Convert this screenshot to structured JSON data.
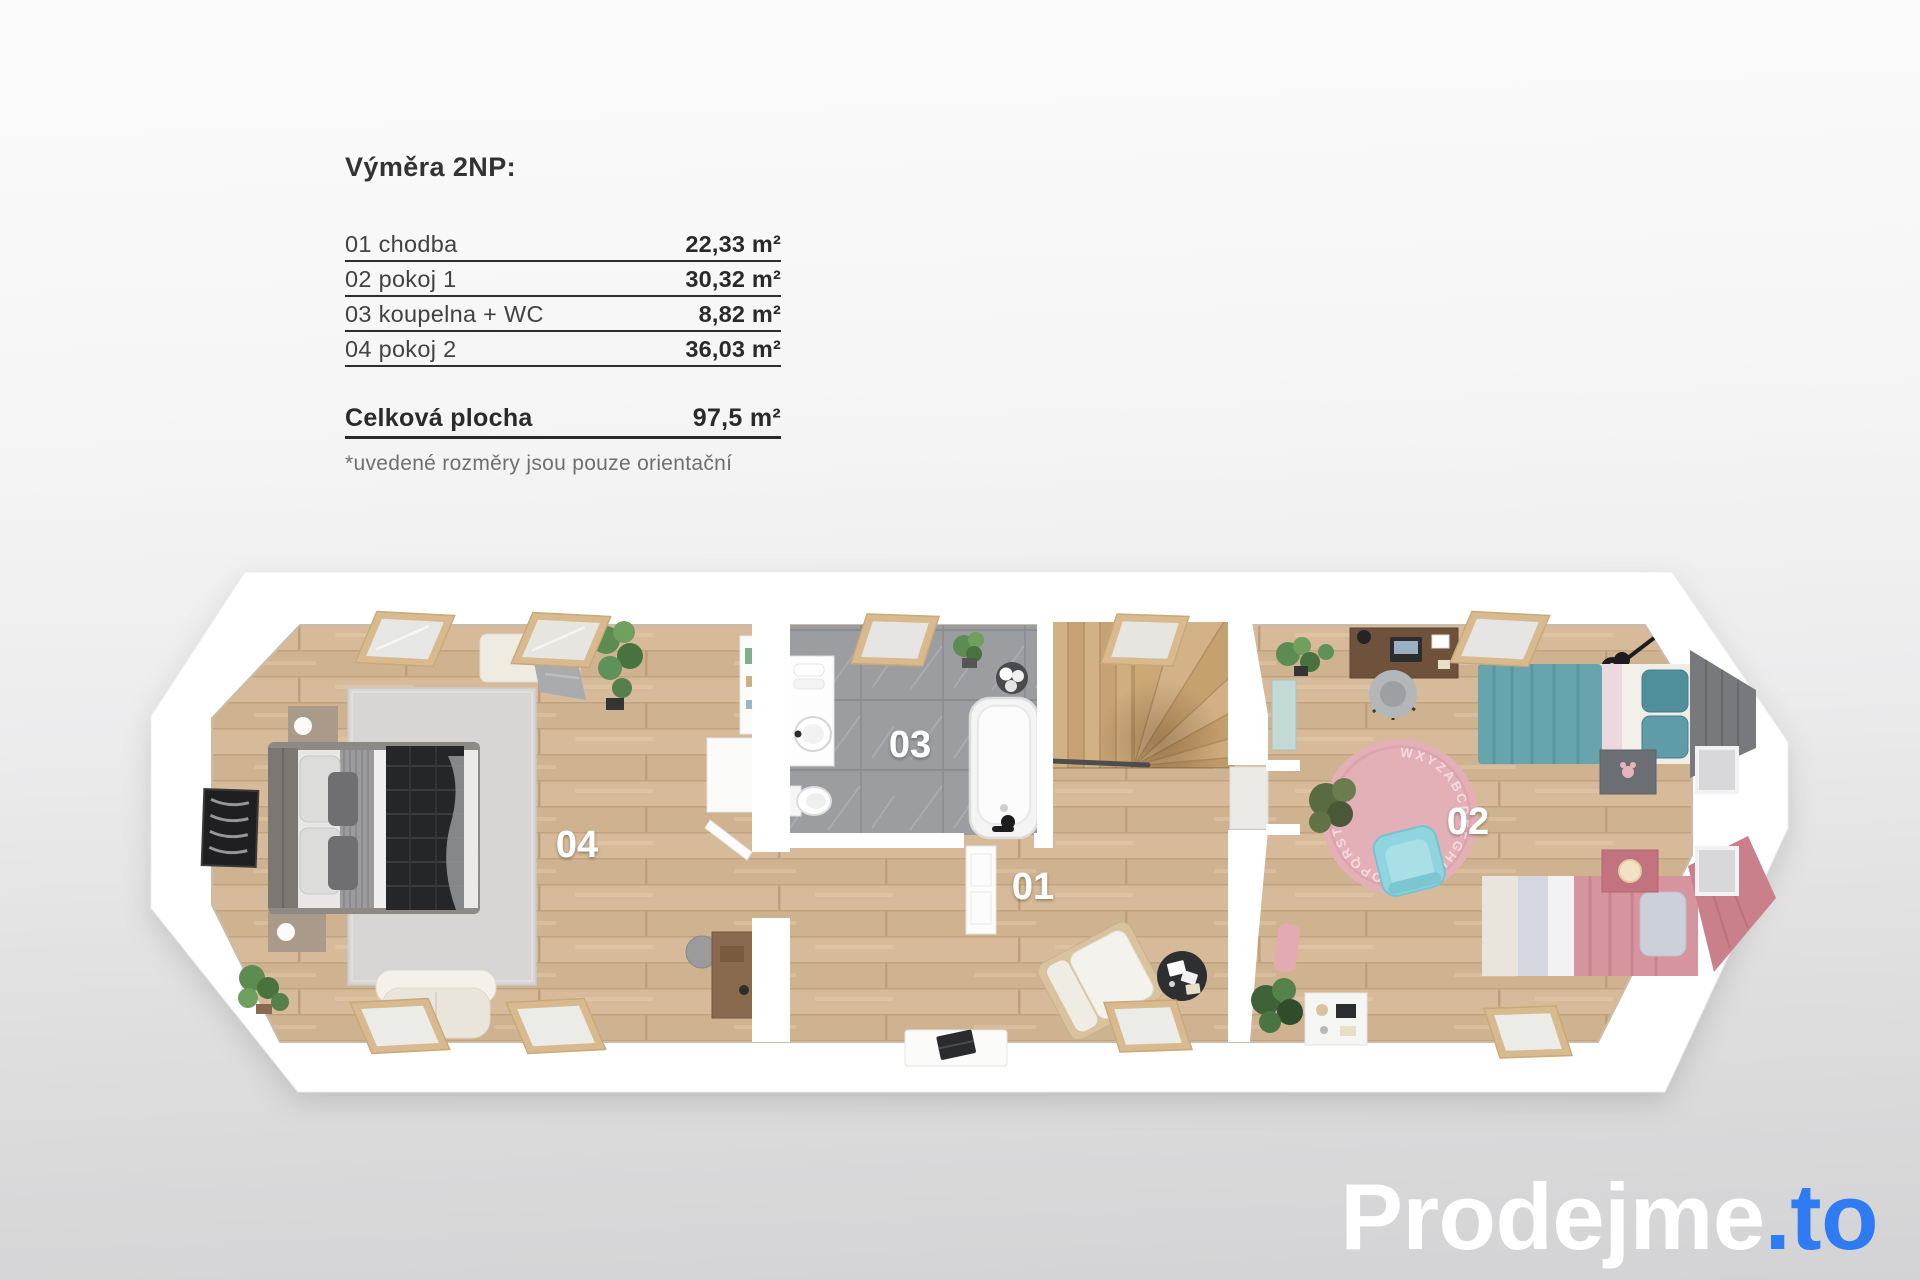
{
  "legend": {
    "title": "Výměra 2NP:",
    "rows": [
      {
        "label": "01 chodba",
        "value": "22,33 m²"
      },
      {
        "label": "02 pokoj 1",
        "value": "30,32 m²"
      },
      {
        "label": "03 koupelna + WC",
        "value": "8,82 m²"
      },
      {
        "label": "04 pokoj 2",
        "value": "36,03 m²"
      }
    ],
    "total_label": "Celková plocha",
    "total_value": "97,5 m²",
    "footnote": "*uvedené rozměry jsou pouze orientační"
  },
  "floorplan": {
    "floor_label": "2NP",
    "room_numbers": {
      "r01": "01",
      "r02": "02",
      "r03": "03",
      "r04": "04"
    },
    "rug_letters": "WXYZABCDEFGHIJKLMNOPQRSTUV"
  },
  "logo": {
    "name": "Prodejme",
    "tld": ".to"
  },
  "colors": {
    "accent_blue": "#2e7bf3",
    "wall_white": "#ffffff",
    "wood_floor": "#d4b896",
    "bathroom_tile": "#9b9da0",
    "teal_bed": "#68a4ad",
    "pink_bed": "#d6949e",
    "rug_pink": "#e4b0b8",
    "rug_gray": "#d7d6d4",
    "dark_blanket": "#242628",
    "background_top": "#fbfbfb",
    "background_bottom": "#d3d3d5"
  }
}
